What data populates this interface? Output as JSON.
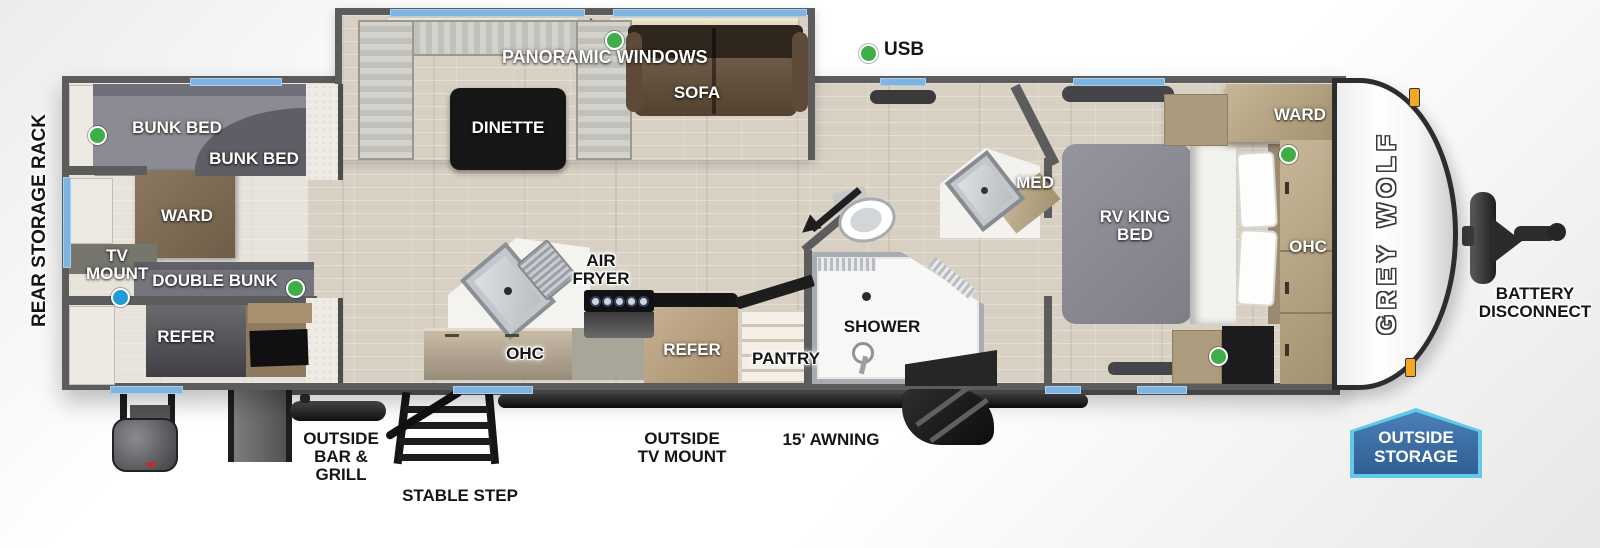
{
  "legend": {
    "usb": "USB",
    "panoramic_windows": "PANORAMIC WINDOWS"
  },
  "bunk_room": {
    "bunk_bed_top": "BUNK BED",
    "bunk_bed_bottom": "BUNK BED",
    "ward": "WARD",
    "tv_mount": "TV MOUNT",
    "double_bunk": "DOUBLE BUNK",
    "refer": "REFER"
  },
  "living": {
    "dinette": "DINETTE",
    "sofa": "SOFA"
  },
  "kitchen": {
    "air_fryer": "AIR FRYER",
    "ohc": "OHC",
    "refer": "REFER",
    "pantry": "PANTRY"
  },
  "bathroom": {
    "med": "MED",
    "shower": "SHOWER"
  },
  "bedroom": {
    "rv_king_bed": "RV KING BED",
    "ward": "WARD",
    "ohc": "OHC"
  },
  "exterior": {
    "rear_storage_rack": "REAR STORAGE RACK",
    "outside_bar_grill": "OUTSIDE BAR & GRILL",
    "stable_step": "STABLE STEP",
    "outside_tv_mount": "OUTSIDE TV MOUNT",
    "awning": "15' AWNING",
    "battery_disconnect": "BATTERY DISCONNECT",
    "outside_storage": "OUTSIDE STORAGE",
    "brand": "GREY WOLF"
  },
  "colors": {
    "window_blue": "#7db4e2",
    "usb_green": "#3fae49",
    "tv_blue": "#1f9cd8",
    "badge_blue": "#2f5f95",
    "badge_border": "#62c9e9",
    "wall_gray": "#5c5c5c"
  }
}
